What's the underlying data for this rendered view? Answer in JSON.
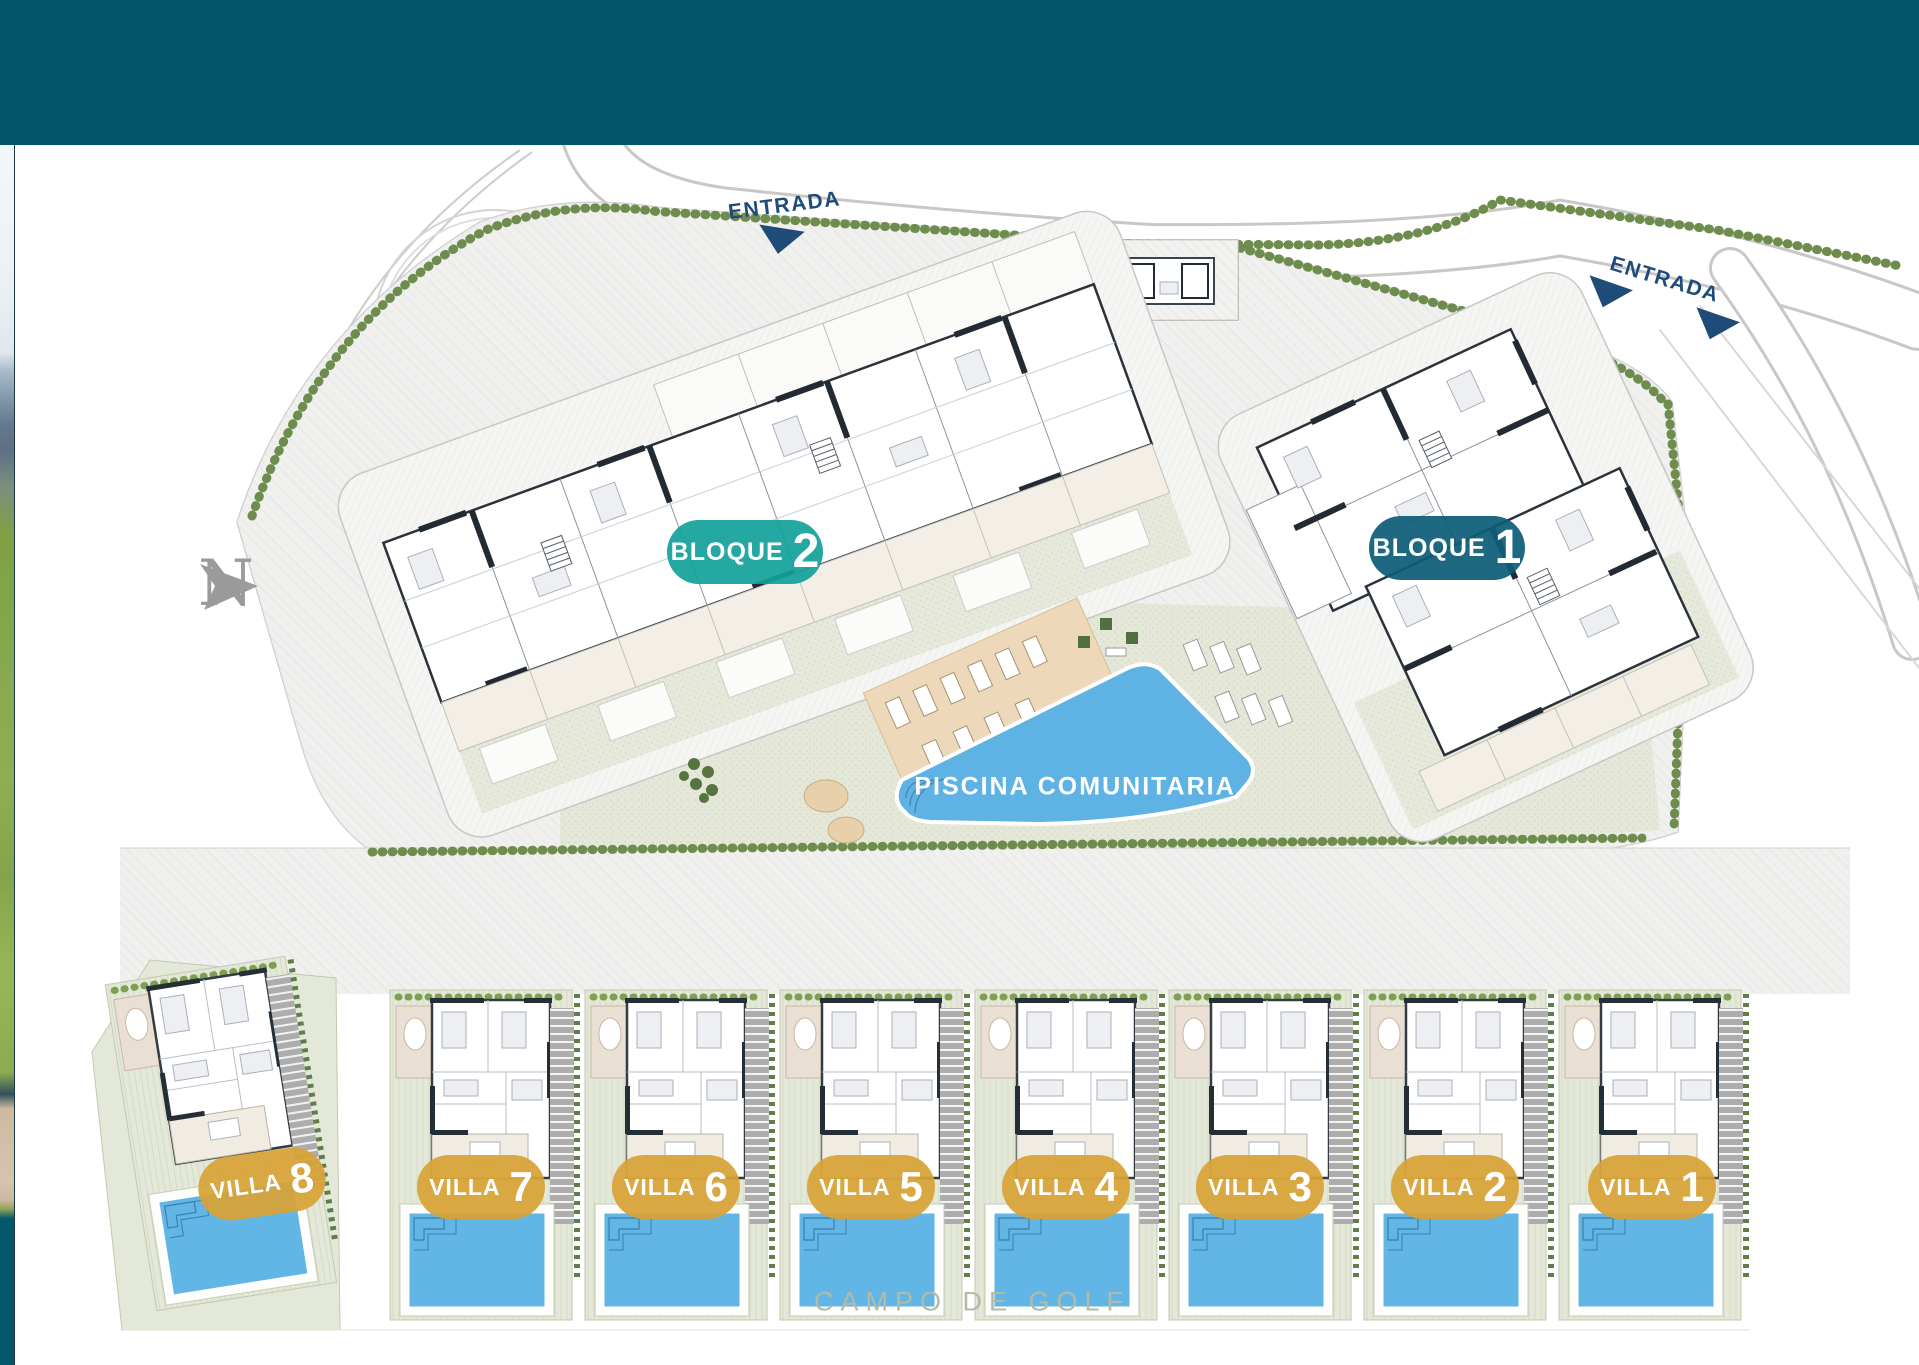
{
  "header": {
    "bar_color": "#04566B"
  },
  "plan": {
    "entrances": [
      {
        "label": "ENTRADA"
      },
      {
        "label": "ENTRADA"
      }
    ],
    "blocks": [
      {
        "label": "BLOQUE",
        "number": "2",
        "color": "rgba(18,161,154,0.92)"
      },
      {
        "label": "BLOQUE",
        "number": "1",
        "color": "rgba(13,94,119,0.93)"
      }
    ],
    "pool": {
      "label": "PISCINA COMUNITARIA",
      "water_color": "#5FB3E4"
    },
    "villas": [
      {
        "label": "VILLA",
        "number": "8"
      },
      {
        "label": "VILLA",
        "number": "7"
      },
      {
        "label": "VILLA",
        "number": "6"
      },
      {
        "label": "VILLA",
        "number": "5"
      },
      {
        "label": "VILLA",
        "number": "4"
      },
      {
        "label": "VILLA",
        "number": "3"
      },
      {
        "label": "VILLA",
        "number": "2"
      },
      {
        "label": "VILLA",
        "number": "1"
      }
    ],
    "villa_badge_color": "rgba(216,163,54,0.93)",
    "labels": {
      "golf": "CAMPO DE GOLF",
      "compass": "N"
    },
    "accents": {
      "navy": "#1E4B78",
      "hedge_green": "#6E8C4D",
      "gold": "#D8A337",
      "pool_blue": "#5FB3E4"
    }
  }
}
